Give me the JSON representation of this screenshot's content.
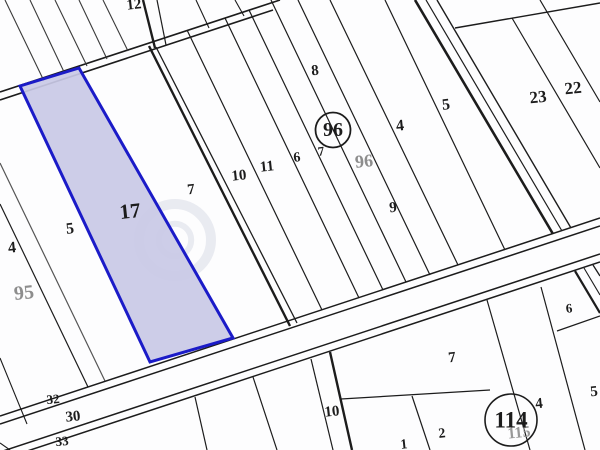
{
  "map": {
    "title": "cadastral-parcel-map",
    "background": "#fdfdfe",
    "line_color": "#1c1c1c",
    "selected_parcel": {
      "label": "17",
      "points": "20,86 79,68 233,338 150,362",
      "fill": "#c9c9e6",
      "stroke": "#1b1bc8",
      "stroke_width": 3
    },
    "lines": [
      {
        "x1": 0,
        "y1": 92,
        "x2": 280,
        "y2": 0,
        "w": 1.6
      },
      {
        "x1": 0,
        "y1": 100,
        "x2": 273,
        "y2": 10,
        "w": 1.6
      },
      {
        "x1": 5,
        "y1": 0,
        "x2": 44,
        "y2": 81,
        "w": 1.1,
        "c": "#3a3a3a"
      },
      {
        "x1": 30,
        "y1": 0,
        "x2": 65,
        "y2": 74,
        "w": 1.1,
        "c": "#3a3a3a"
      },
      {
        "x1": 55,
        "y1": 0,
        "x2": 87,
        "y2": 66,
        "w": 1.1,
        "c": "#3a3a3a"
      },
      {
        "x1": 79,
        "y1": 0,
        "x2": 107,
        "y2": 59,
        "w": 1.1,
        "c": "#3a3a3a"
      },
      {
        "x1": 103,
        "y1": 0,
        "x2": 128,
        "y2": 51,
        "w": 1.1,
        "c": "#3a3a3a"
      },
      {
        "x1": 143,
        "y1": 0,
        "x2": 155,
        "y2": 48,
        "w": 2.4
      },
      {
        "x1": 157,
        "y1": 0,
        "x2": 166,
        "y2": 45,
        "w": 1.2
      },
      {
        "x1": 196,
        "y1": 0,
        "x2": 209,
        "y2": 28,
        "w": 1.1
      },
      {
        "x1": 235,
        "y1": 0,
        "x2": 244,
        "y2": 16,
        "w": 1.1
      },
      {
        "x1": 149,
        "y1": 46,
        "x2": 290,
        "y2": 326,
        "w": 2.4
      },
      {
        "x1": 156,
        "y1": 47,
        "x2": 297,
        "y2": 323,
        "w": 1.3
      },
      {
        "x1": 0,
        "y1": 358,
        "x2": 27,
        "y2": 424,
        "w": 1.1
      },
      {
        "x1": 0,
        "y1": 163,
        "x2": 105,
        "y2": 381,
        "w": 1.2,
        "c": "#555555"
      },
      {
        "x1": 0,
        "y1": 204,
        "x2": 88,
        "y2": 387,
        "w": 1.2
      },
      {
        "x1": 187,
        "y1": 30,
        "x2": 322,
        "y2": 310,
        "w": 1.2
      },
      {
        "x1": 225,
        "y1": 18,
        "x2": 359,
        "y2": 298,
        "w": 1.2
      },
      {
        "x1": 249,
        "y1": 10,
        "x2": 383,
        "y2": 290,
        "w": 1.2
      },
      {
        "x1": 271,
        "y1": 0,
        "x2": 406,
        "y2": 282,
        "w": 1.2
      },
      {
        "x1": 298,
        "y1": 0,
        "x2": 430,
        "y2": 275,
        "w": 1.2
      },
      {
        "x1": 330,
        "y1": 0,
        "x2": 458,
        "y2": 265,
        "w": 1.2
      },
      {
        "x1": 385,
        "y1": 0,
        "x2": 505,
        "y2": 250,
        "w": 1.2
      },
      {
        "x1": 415,
        "y1": 0,
        "x2": 553,
        "y2": 234,
        "w": 2.6
      },
      {
        "x1": 426,
        "y1": 0,
        "x2": 562,
        "y2": 231,
        "w": 1.2
      },
      {
        "x1": 437,
        "y1": 0,
        "x2": 571,
        "y2": 228,
        "w": 1.4
      },
      {
        "x1": 575,
        "y1": 271,
        "x2": 600,
        "y2": 313,
        "w": 2.2
      },
      {
        "x1": 584,
        "y1": 268,
        "x2": 600,
        "y2": 295,
        "w": 1.1
      },
      {
        "x1": 593,
        "y1": 265,
        "x2": 600,
        "y2": 276,
        "w": 1.3
      },
      {
        "x1": 455,
        "y1": 28,
        "x2": 600,
        "y2": 3,
        "w": 1.4
      },
      {
        "x1": 512,
        "y1": 18,
        "x2": 600,
        "y2": 168,
        "w": 1.2
      },
      {
        "x1": 540,
        "y1": 0,
        "x2": 600,
        "y2": 102,
        "w": 1.2
      },
      {
        "x1": 0,
        "y1": 416,
        "x2": 600,
        "y2": 218,
        "w": 1.5
      },
      {
        "x1": 0,
        "y1": 424,
        "x2": 600,
        "y2": 226,
        "w": 1.5
      },
      {
        "x1": 0,
        "y1": 452,
        "x2": 600,
        "y2": 254,
        "w": 1.5
      },
      {
        "x1": 0,
        "y1": 460,
        "x2": 600,
        "y2": 262,
        "w": 1.5
      },
      {
        "x1": 195,
        "y1": 397,
        "x2": 207,
        "y2": 450,
        "w": 1.2
      },
      {
        "x1": 253,
        "y1": 377,
        "x2": 277,
        "y2": 450,
        "w": 1.2
      },
      {
        "x1": 311,
        "y1": 359,
        "x2": 333,
        "y2": 450,
        "w": 1.2
      },
      {
        "x1": 330,
        "y1": 352,
        "x2": 352,
        "y2": 450,
        "w": 2.4
      },
      {
        "x1": 341,
        "y1": 399,
        "x2": 490,
        "y2": 390,
        "w": 1.2
      },
      {
        "x1": 412,
        "y1": 396,
        "x2": 430,
        "y2": 450,
        "w": 1.2
      },
      {
        "x1": 487,
        "y1": 300,
        "x2": 530,
        "y2": 450,
        "w": 1.2
      },
      {
        "x1": 541,
        "y1": 287,
        "x2": 585,
        "y2": 450,
        "w": 1.2
      },
      {
        "x1": 557,
        "y1": 331,
        "x2": 600,
        "y2": 316,
        "w": 1.2
      },
      {
        "x1": 0,
        "y1": 443,
        "x2": 10,
        "y2": 450,
        "w": 1.1
      }
    ],
    "labels": [
      {
        "text": "12",
        "x": 134,
        "y": 5,
        "s": 15
      },
      {
        "text": "8",
        "x": 315,
        "y": 71,
        "s": 15
      },
      {
        "text": "4",
        "x": 400,
        "y": 126,
        "s": 16
      },
      {
        "text": "5",
        "x": 446,
        "y": 105,
        "s": 16
      },
      {
        "text": "23",
        "x": 538,
        "y": 97,
        "s": 17
      },
      {
        "text": "22",
        "x": 573,
        "y": 88,
        "s": 17
      },
      {
        "text": "10",
        "x": 239,
        "y": 176,
        "s": 15
      },
      {
        "text": "11",
        "x": 267,
        "y": 167,
        "s": 15
      },
      {
        "text": "6",
        "x": 297,
        "y": 158,
        "s": 14
      },
      {
        "text": "7",
        "x": 321,
        "y": 151,
        "s": 13
      },
      {
        "text": "96",
        "x": 364,
        "y": 161,
        "s": 18,
        "c": "#8d8d8d"
      },
      {
        "text": "9",
        "x": 393,
        "y": 208,
        "s": 15
      },
      {
        "text": "7",
        "x": 191,
        "y": 190,
        "s": 15
      },
      {
        "text": "17",
        "x": 130,
        "y": 211,
        "s": 21
      },
      {
        "text": "5",
        "x": 70,
        "y": 229,
        "s": 16
      },
      {
        "text": "4",
        "x": 12,
        "y": 248,
        "s": 16
      },
      {
        "text": "95",
        "x": 24,
        "y": 293,
        "s": 20,
        "c": "#8d8d8d"
      },
      {
        "text": "32",
        "x": 53,
        "y": 399,
        "s": 13
      },
      {
        "text": "30",
        "x": 73,
        "y": 417,
        "s": 15
      },
      {
        "text": "33",
        "x": 62,
        "y": 441,
        "s": 13
      },
      {
        "text": "10",
        "x": 332,
        "y": 412,
        "s": 15
      },
      {
        "text": "7",
        "x": 452,
        "y": 358,
        "s": 15
      },
      {
        "text": "2",
        "x": 442,
        "y": 434,
        "s": 14
      },
      {
        "text": "1",
        "x": 404,
        "y": 445,
        "s": 14
      },
      {
        "text": "4",
        "x": 539,
        "y": 404,
        "s": 15
      },
      {
        "text": "115",
        "x": 519,
        "y": 433,
        "s": 16,
        "c": "#999999"
      },
      {
        "text": "5",
        "x": 594,
        "y": 392,
        "s": 15
      },
      {
        "text": "6",
        "x": 569,
        "y": 308,
        "s": 13
      }
    ],
    "circled": [
      {
        "text": "96",
        "x": 333,
        "y": 130,
        "r": 17.5,
        "s": 20,
        "sw": 1.8
      },
      {
        "text": "114",
        "x": 511,
        "y": 420,
        "r": 26,
        "s": 23,
        "sw": 1.6
      }
    ],
    "watermark": {
      "cx": 175,
      "cy": 240,
      "r": 36,
      "color": "#8890b0",
      "opacity": 0.16
    }
  }
}
